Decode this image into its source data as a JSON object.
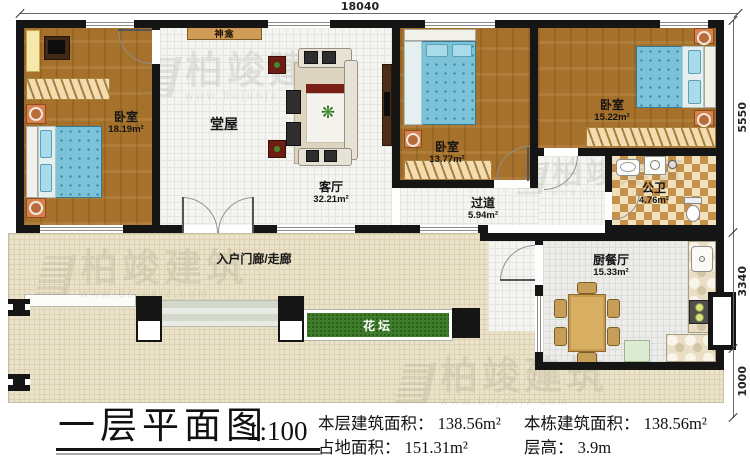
{
  "dims": {
    "top": "18040",
    "right": [
      "5550",
      "3340",
      "1000"
    ]
  },
  "rooms": {
    "bedroom_left": {
      "label": "卧室",
      "area": "18.19m²"
    },
    "hall": {
      "label": "堂屋"
    },
    "living": {
      "label": "客厅",
      "area": "32.21m²"
    },
    "bedroom_mid": {
      "label": "卧室",
      "area": "13.77m²"
    },
    "bedroom_right": {
      "label": "卧室",
      "area": "15.22m²"
    },
    "bathroom": {
      "label": "公卫",
      "area": "4.76m²"
    },
    "corridor": {
      "label": "过道",
      "area": "5.94m²"
    },
    "kitchen": {
      "label": "厨餐厅",
      "area": "15.33m²"
    },
    "porch": {
      "label": "入户门廊/走廊"
    },
    "flowerbed": {
      "label": "花坛"
    },
    "shrine": {
      "label": "神龛"
    }
  },
  "title": {
    "text": "一层平面图",
    "scale": "1:100"
  },
  "stats": {
    "floor_area_label": "本层建筑面积：",
    "floor_area": "138.56m²",
    "footprint_label": "占地面积：",
    "footprint": "151.31m²",
    "building_area_label": "本栋建筑面积：",
    "building_area": "138.56m²",
    "height_label": "层高：",
    "height": "3.9m"
  },
  "watermark": {
    "brand": "柏竣建筑",
    "url": "www.bojunjz.com"
  },
  "colors": {
    "wall": "#151515",
    "wood_floor": "#a6712b",
    "bed_blue": "#7cc3d9",
    "nightstand_orange": "#d9814e",
    "flowerbed_green": "#3e7d2b",
    "accent_red": "#6e1d15"
  }
}
